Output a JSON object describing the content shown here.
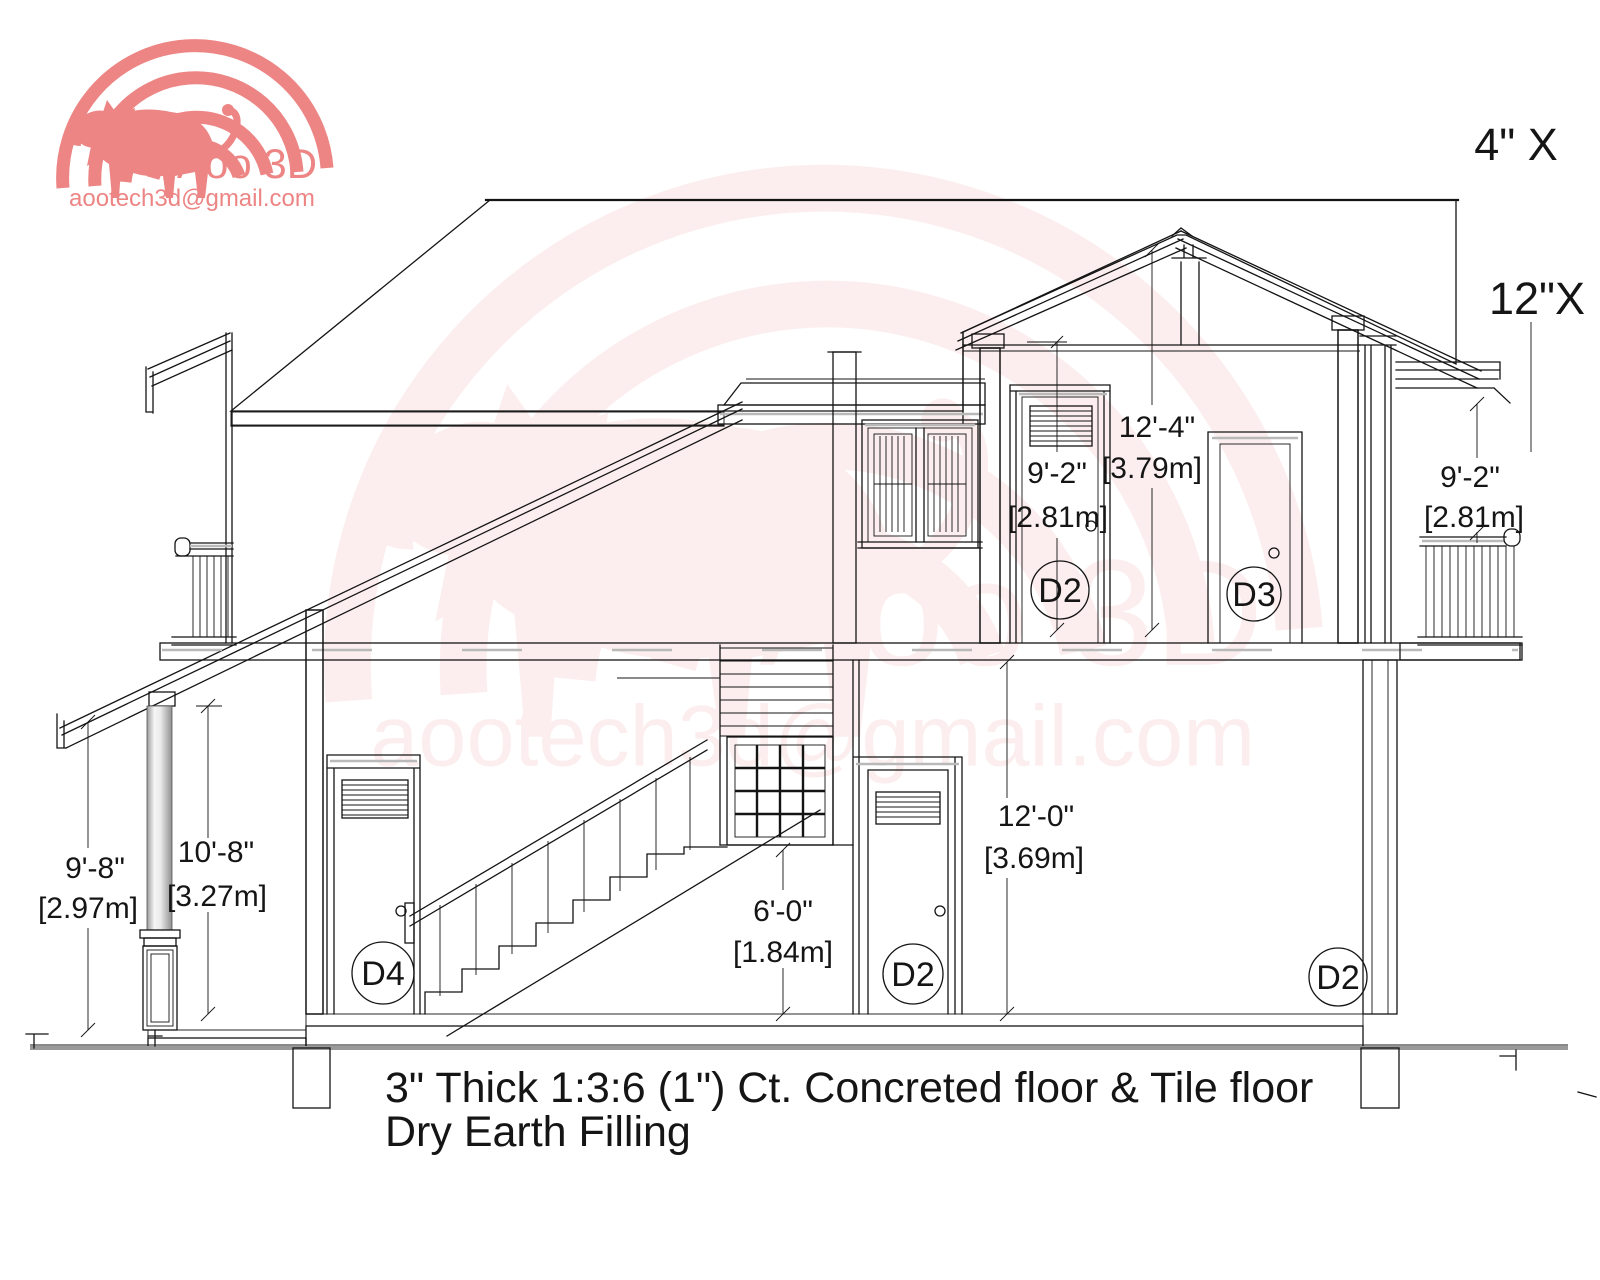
{
  "title": "House cross-section drawing",
  "logo": {
    "brand": "Aoo 3D",
    "email": "aootech3d@gmail.com"
  },
  "watermark": {
    "brand": "Aoo 3D",
    "email": "aootech3d@gmail.com"
  },
  "roof_labels": {
    "label_1": "4\" X",
    "label_2": "12\"X"
  },
  "dimensions": {
    "porch_height_ft": "9'-8\"",
    "porch_height_m": "[2.97m]",
    "veranda_height_ft": "10'-8\"",
    "veranda_height_m": "[3.27m]",
    "stair_window_ft": "6'-0\"",
    "stair_window_m": "[1.84m]",
    "ground_storey_ft": "12'-0\"",
    "ground_storey_m": "[3.69m]",
    "upper_storey_ft": "12'-4\"",
    "upper_storey_m": "[3.79m]",
    "upper_door_ft": "9'-2\"",
    "upper_door_m": "[2.81m]",
    "balcony_ft": "9'-2\"",
    "balcony_m": "[2.81m]"
  },
  "door_tags": {
    "d4": "D4",
    "d2_ground": "D2",
    "d2_upper": "D2",
    "d3": "D3",
    "d2_right": "D2"
  },
  "notes": {
    "line1": "3\" Thick 1:3:6 (1\") Ct. Concreted floor & Tile floor",
    "line2": "Dry Earth Filling"
  },
  "colors": {
    "line": "#141414",
    "brand": "#ed8585",
    "watermark_tint": "#f2b9b4",
    "accent_gray": "#b9b9b9"
  }
}
